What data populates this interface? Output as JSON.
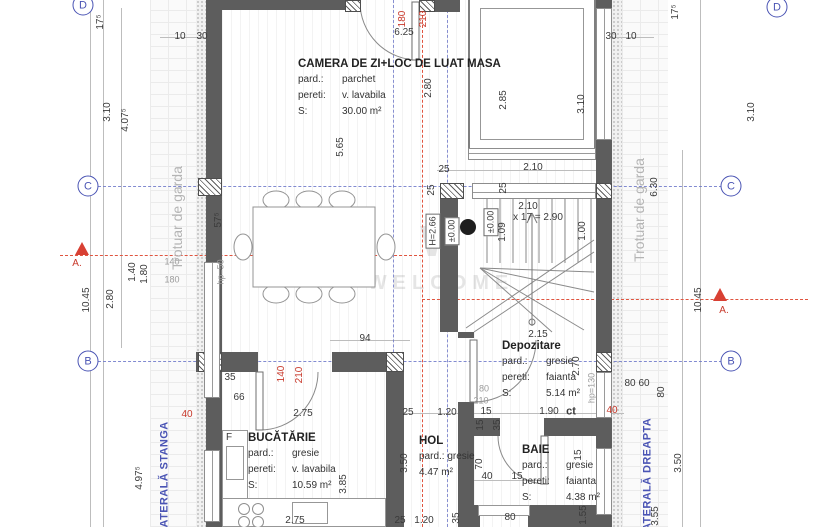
{
  "watermark": {
    "logo": "W",
    "text": "WELCOME"
  },
  "colors": {
    "wall": "#5d5d5d",
    "axis_blue": "#4a54b4",
    "section_red": "#e0543f",
    "dim_text": "#3a3a3a",
    "muted_text": "#9b9b9b"
  },
  "rooms": [
    {
      "key": "camera",
      "x": 298,
      "y": 58,
      "title": "CAMERA DE ZI+LOC DE LUAT MASA",
      "rows": [
        [
          "pard.:",
          "parchet"
        ],
        [
          "pereti:",
          "v. lavabila"
        ],
        [
          "S:",
          "30.00 m²"
        ]
      ]
    },
    {
      "key": "bucatarie",
      "x": 248,
      "y": 432,
      "title": "BUCĂTĂRIE",
      "rows": [
        [
          "pard.:",
          "gresie"
        ],
        [
          "pereti:",
          "v. lavabila"
        ],
        [
          "S:",
          "10.59 m²"
        ]
      ]
    },
    {
      "key": "hol",
      "x": 419,
      "y": 435,
      "title": "HOL",
      "rows": [
        [
          "pard.: gresie",
          ""
        ],
        [
          "4.47 m²",
          ""
        ]
      ]
    },
    {
      "key": "baie",
      "x": 522,
      "y": 444,
      "title": "BAIE",
      "rows": [
        [
          "pard.:",
          "gresie"
        ],
        [
          "pereti:",
          "faianta"
        ],
        [
          "S:",
          "4.38 m²"
        ]
      ]
    },
    {
      "key": "depozitare",
      "x": 502,
      "y": 340,
      "title": "Depozitare",
      "rows": [
        [
          "pard.:",
          "gresie"
        ],
        [
          "pereti:",
          "faianta"
        ],
        [
          "S:",
          "5.14 m²"
        ]
      ]
    }
  ],
  "axis_bubbles": [
    {
      "t": "D",
      "x": 83,
      "y": 5
    },
    {
      "t": "D",
      "x": 777,
      "y": 7
    },
    {
      "t": "C",
      "x": 88,
      "y": 186
    },
    {
      "t": "C",
      "x": 731,
      "y": 186
    },
    {
      "t": "B",
      "x": 88,
      "y": 361
    },
    {
      "t": "B",
      "x": 731,
      "y": 361
    }
  ],
  "dimensions": [
    {
      "t": "17⁵",
      "x": 101,
      "y": 22,
      "o": "v"
    },
    {
      "t": "3.10",
      "x": 108,
      "y": 112,
      "o": "v"
    },
    {
      "t": "4.07⁵",
      "x": 126,
      "y": 120,
      "o": "v"
    },
    {
      "t": "10.45",
      "x": 87,
      "y": 300,
      "o": "v"
    },
    {
      "t": "2.80",
      "x": 111,
      "y": 299,
      "o": "v"
    },
    {
      "t": "1.40",
      "x": 133,
      "y": 272,
      "o": "v"
    },
    {
      "t": "1.80",
      "x": 145,
      "y": 274,
      "o": "v"
    },
    {
      "t": "140",
      "x": 172,
      "y": 262,
      "c": "gray"
    },
    {
      "t": "180",
      "x": 172,
      "y": 280,
      "c": "gray"
    },
    {
      "t": "4.97⁵",
      "x": 140,
      "y": 478,
      "o": "v"
    },
    {
      "t": "LATERALĂ STANGA",
      "x": 165,
      "y": 478,
      "o": "v",
      "c": "blue"
    },
    {
      "t": "Trotuar de garda",
      "x": 177,
      "y": 218,
      "o": "v",
      "c": "biggray"
    },
    {
      "t": "57⁵",
      "x": 219,
      "y": 220,
      "o": "v"
    },
    {
      "t": "hp=50",
      "x": 221,
      "y": 272,
      "o": "v",
      "c": "gray"
    },
    {
      "t": "35",
      "x": 230,
      "y": 378
    },
    {
      "t": "66",
      "x": 239,
      "y": 398
    },
    {
      "t": "2.75",
      "x": 303,
      "y": 414
    },
    {
      "t": "140",
      "x": 282,
      "y": 374,
      "o": "v",
      "c": "red"
    },
    {
      "t": "210",
      "x": 300,
      "y": 375,
      "o": "v",
      "c": "red"
    },
    {
      "t": "F",
      "x": 229,
      "y": 438
    },
    {
      "t": "40",
      "x": 187,
      "y": 415,
      "c": "red"
    },
    {
      "t": "10",
      "x": 180,
      "y": 37
    },
    {
      "t": "30",
      "x": 202,
      "y": 37
    },
    {
      "t": "6.25",
      "x": 404,
      "y": 33
    },
    {
      "t": "180",
      "x": 403,
      "y": 19,
      "o": "v",
      "c": "red"
    },
    {
      "t": "210",
      "x": 424,
      "y": 19,
      "o": "v",
      "c": "red"
    },
    {
      "t": "2.80",
      "x": 429,
      "y": 88,
      "o": "v"
    },
    {
      "t": "5.65",
      "x": 341,
      "y": 147,
      "o": "v"
    },
    {
      "t": "2.85",
      "x": 504,
      "y": 100,
      "o": "v"
    },
    {
      "t": "3.10",
      "x": 582,
      "y": 104,
      "o": "v"
    },
    {
      "t": "30",
      "x": 611,
      "y": 37
    },
    {
      "t": "10",
      "x": 631,
      "y": 37
    },
    {
      "t": "17⁵",
      "x": 676,
      "y": 12,
      "o": "v"
    },
    {
      "t": "3.10",
      "x": 752,
      "y": 112,
      "o": "v"
    },
    {
      "t": "25",
      "x": 444,
      "y": 170
    },
    {
      "t": "2.10",
      "x": 533,
      "y": 168
    },
    {
      "t": "25",
      "x": 432,
      "y": 190,
      "o": "v"
    },
    {
      "t": "25",
      "x": 504,
      "y": 188,
      "o": "v"
    },
    {
      "t": "H=2.66",
      "x": 433,
      "y": 231,
      "o": "v",
      "c": "box"
    },
    {
      "t": "±0.00",
      "x": 452,
      "y": 231,
      "o": "v",
      "c": "box"
    },
    {
      "t": "±0.00",
      "x": 491,
      "y": 222,
      "o": "v",
      "c": "box"
    },
    {
      "t": "2.10",
      "x": 528,
      "y": 207
    },
    {
      "t": "x 17 = 2.90",
      "x": 538,
      "y": 218
    },
    {
      "t": "1.09",
      "x": 503,
      "y": 232,
      "o": "v"
    },
    {
      "t": "1.00",
      "x": 583,
      "y": 231,
      "o": "v"
    },
    {
      "t": "6.30",
      "x": 655,
      "y": 187,
      "o": "v"
    },
    {
      "t": "Trotuar de garda",
      "x": 639,
      "y": 210,
      "o": "v",
      "c": "biggray"
    },
    {
      "t": "10.45",
      "x": 699,
      "y": 300,
      "o": "v"
    },
    {
      "t": "2.15",
      "x": 538,
      "y": 335
    },
    {
      "t": "94",
      "x": 365,
      "y": 339
    },
    {
      "t": "25",
      "x": 408,
      "y": 413
    },
    {
      "t": "1.20",
      "x": 447,
      "y": 413
    },
    {
      "t": "15",
      "x": 486,
      "y": 412
    },
    {
      "t": "1.90",
      "x": 549,
      "y": 412
    },
    {
      "t": "ct",
      "x": 571,
      "y": 412,
      "c": "bold"
    },
    {
      "t": "40",
      "x": 612,
      "y": 411,
      "c": "red"
    },
    {
      "t": "35",
      "x": 498,
      "y": 425,
      "o": "v"
    },
    {
      "t": "15",
      "x": 481,
      "y": 425,
      "o": "v"
    },
    {
      "t": "80",
      "x": 484,
      "y": 389,
      "c": "gray"
    },
    {
      "t": "210",
      "x": 481,
      "y": 401,
      "c": "gray"
    },
    {
      "t": "2.70",
      "x": 577,
      "y": 366,
      "o": "v"
    },
    {
      "t": "hp=130",
      "x": 592,
      "y": 388,
      "o": "v",
      "c": "gray"
    },
    {
      "t": "80",
      "x": 630,
      "y": 384
    },
    {
      "t": "60",
      "x": 644,
      "y": 384
    },
    {
      "t": "80",
      "x": 662,
      "y": 392,
      "o": "v"
    },
    {
      "t": "40",
      "x": 487,
      "y": 477
    },
    {
      "t": "15",
      "x": 517,
      "y": 477
    },
    {
      "t": "70",
      "x": 480,
      "y": 464,
      "o": "v"
    },
    {
      "t": "15",
      "x": 579,
      "y": 455,
      "o": "v"
    },
    {
      "t": "2.75",
      "x": 295,
      "y": 521
    },
    {
      "t": "25",
      "x": 400,
      "y": 521
    },
    {
      "t": "1.20",
      "x": 424,
      "y": 521
    },
    {
      "t": "35",
      "x": 457,
      "y": 518,
      "o": "v"
    },
    {
      "t": "80",
      "x": 510,
      "y": 518
    },
    {
      "t": "1.55",
      "x": 584,
      "y": 515,
      "o": "v"
    },
    {
      "t": "3.55",
      "x": 656,
      "y": 516,
      "o": "v"
    },
    {
      "t": "3.50",
      "x": 679,
      "y": 463,
      "o": "v"
    },
    {
      "t": "3.50",
      "x": 405,
      "y": 463,
      "o": "v"
    },
    {
      "t": "3.85",
      "x": 344,
      "y": 484,
      "o": "v"
    },
    {
      "t": "LATERALĂ DREAPTA",
      "x": 648,
      "y": 478,
      "o": "v",
      "c": "blue"
    },
    {
      "t": "A.",
      "x": 77,
      "y": 264,
      "c": "red"
    },
    {
      "t": "A.",
      "x": 724,
      "y": 311,
      "c": "red"
    }
  ]
}
